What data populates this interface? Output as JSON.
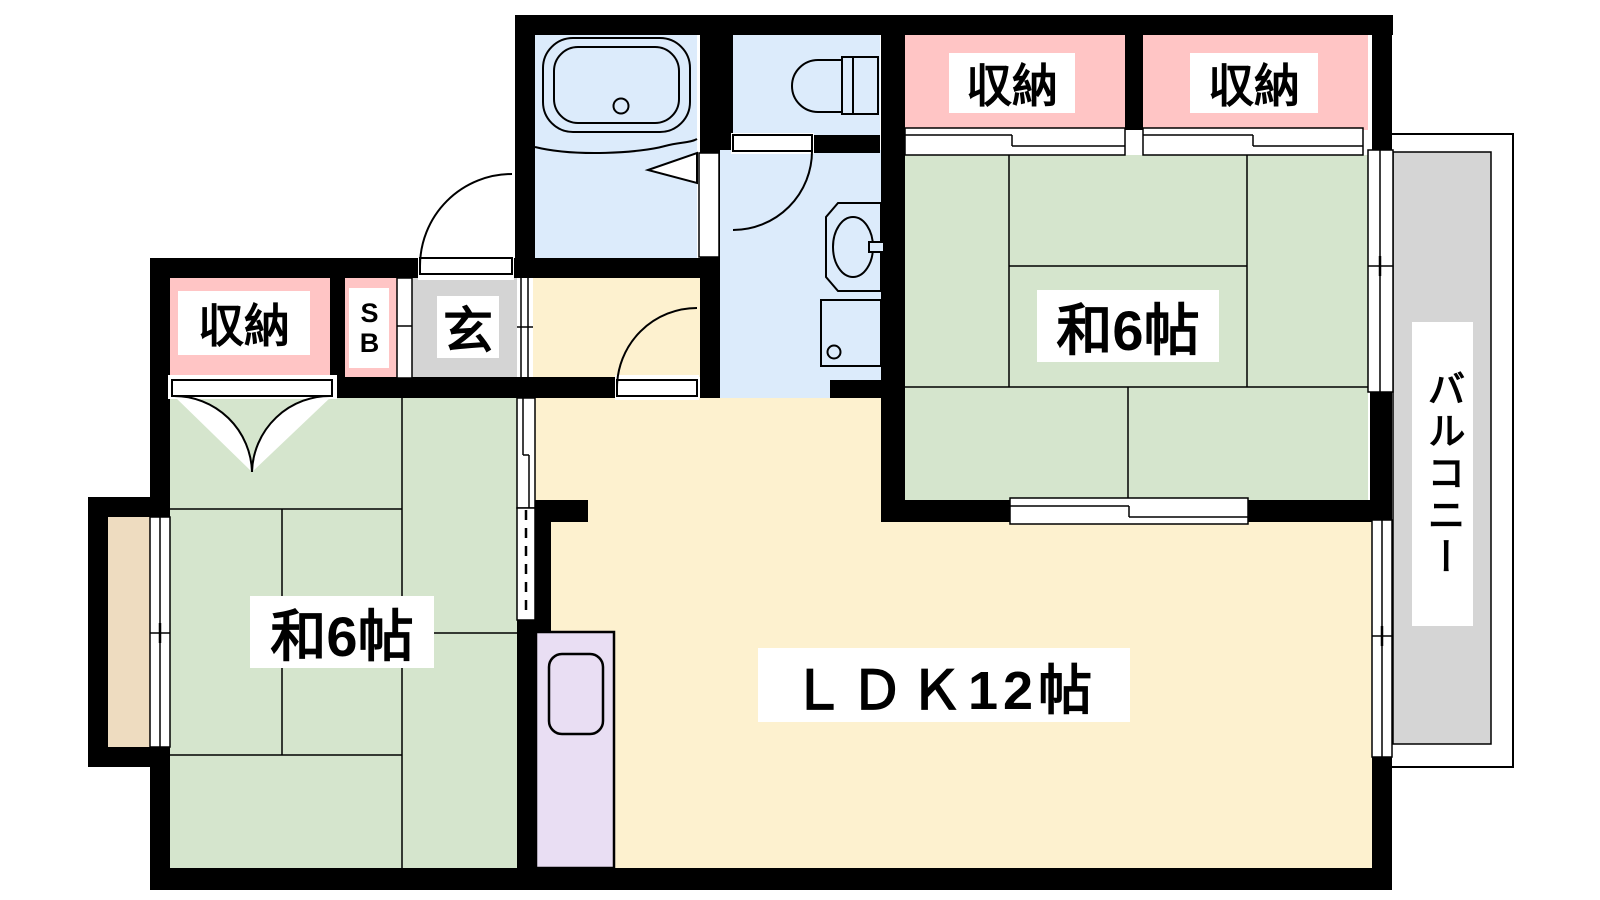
{
  "floor_plan": {
    "labels": {
      "storage_west": "収納",
      "shoe_box": "SB",
      "entrance": "玄",
      "storage_ne_1": "収納",
      "storage_ne_2": "収納",
      "japanese_room_west": "和6帖",
      "japanese_room_east": "和6帖",
      "ldk": "ＬＤＫ12帖",
      "balcony": "バルコニー"
    },
    "colors": {
      "tatami_green": "#d5e5cd",
      "storage_pink": "#ffc5c5",
      "wet_area_blue": "#dcebfb",
      "ldk_cream": "#fdf1cf",
      "entrance_gray": "#d4d4d4",
      "balcony_gray": "#d5d5d5",
      "kitchen_purple": "#e9def3",
      "bay_window_beige": "#eedcc0",
      "wall_black": "#000000"
    },
    "fixtures": [
      "bathtub",
      "toilet",
      "washbasin",
      "washing-machine",
      "kitchen-sink"
    ]
  }
}
